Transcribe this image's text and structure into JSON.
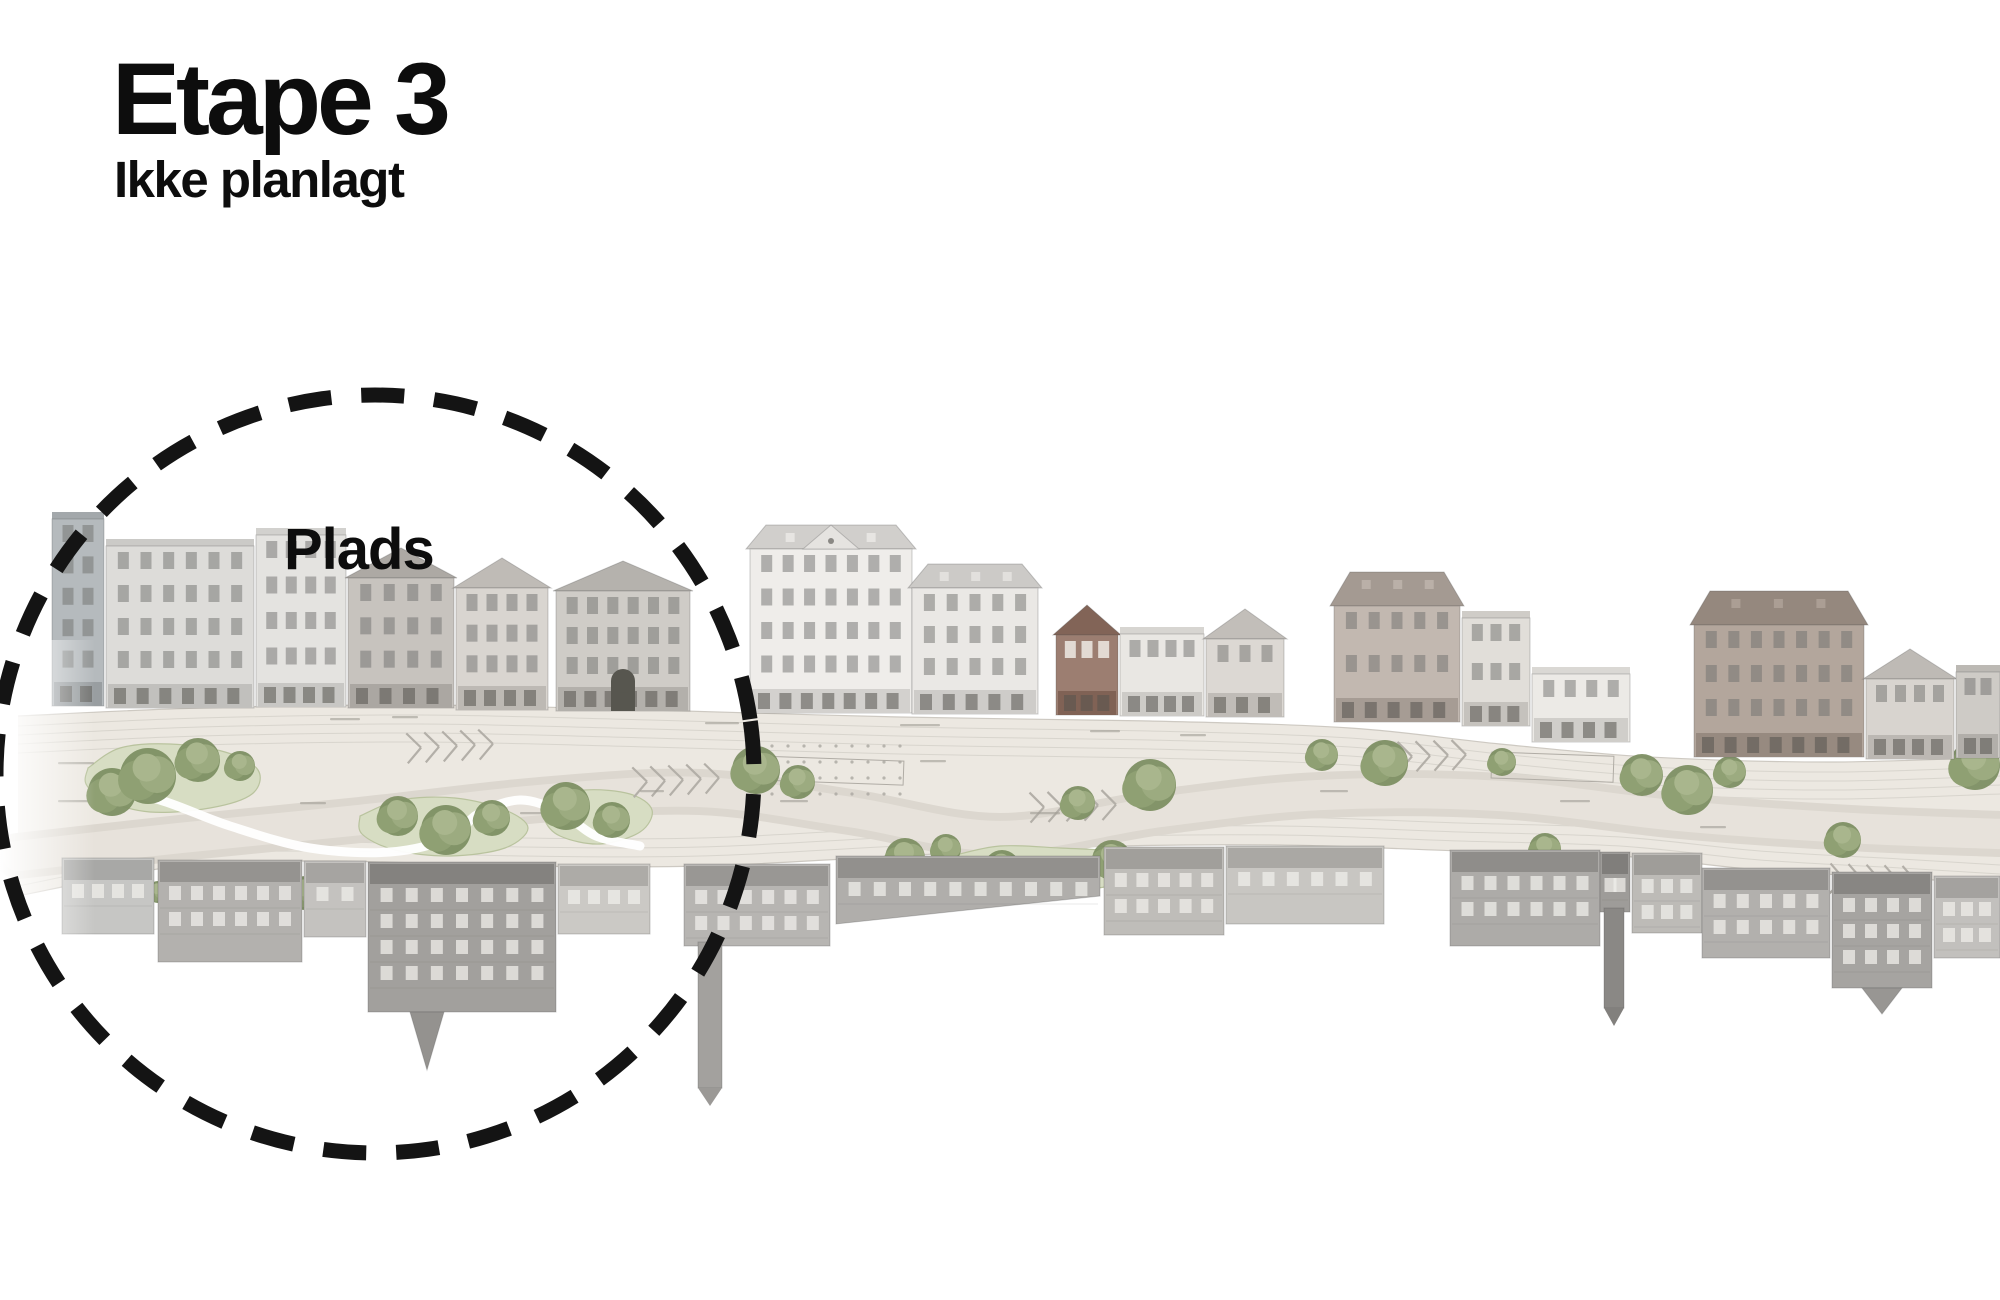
{
  "header": {
    "title": "Etape 3",
    "subtitle": "Ikke planlagt"
  },
  "annotation": {
    "label": "Plads",
    "circle": {
      "cx": 375,
      "cy": 774,
      "r": 379,
      "color": "#141414",
      "stroke_width": 15,
      "dash": "43 30"
    }
  },
  "palette": {
    "strip": "#ece8e1",
    "strip_edge": "#c9c4bd",
    "road": "#dcd7cf",
    "road_inner": "#e8e3dc",
    "lane": "#c9c5be",
    "lawn": "#d7ddc3",
    "lawn_edge": "#b9c39e",
    "tree_base": "#7d8f63",
    "tree_mid": "#8fa073",
    "tree_light": "#9cab80",
    "tree_top": "#a9b68d",
    "hatch": "#b3afa8",
    "dots": "#aaa6a0",
    "zone": "#b0aca5",
    "label_mark": "#a09c95",
    "path_white": "#ffffff",
    "win_dark": "#70706e",
    "win_light": "#efeeea",
    "store_pane": "#55544f",
    "outline": "rgba(80,80,78,0.28)"
  },
  "panorama": {
    "strip_top": [
      [
        18,
        716
      ],
      [
        200,
        708
      ],
      [
        420,
        705
      ],
      [
        650,
        710
      ],
      [
        900,
        717
      ],
      [
        1150,
        721
      ],
      [
        1350,
        728
      ],
      [
        1500,
        744
      ],
      [
        1650,
        757
      ],
      [
        1830,
        762
      ],
      [
        2000,
        757
      ]
    ],
    "strip_bottom": [
      [
        18,
        896
      ],
      [
        180,
        866
      ],
      [
        330,
        861
      ],
      [
        520,
        866
      ],
      [
        700,
        866
      ],
      [
        880,
        857
      ],
      [
        1080,
        847
      ],
      [
        1280,
        845
      ],
      [
        1460,
        851
      ],
      [
        1620,
        856
      ],
      [
        1760,
        870
      ],
      [
        1900,
        878
      ],
      [
        2000,
        884
      ]
    ],
    "road": {
      "points": [
        [
          18,
          856
        ],
        [
          180,
          838
        ],
        [
          360,
          820
        ],
        [
          540,
          800
        ],
        [
          700,
          792
        ],
        [
          850,
          812
        ],
        [
          1000,
          836
        ],
        [
          1160,
          812
        ],
        [
          1320,
          795
        ],
        [
          1500,
          796
        ],
        [
          1680,
          816
        ],
        [
          1850,
          828
        ],
        [
          2000,
          834
        ]
      ],
      "width": 46
    },
    "white_path": [
      [
        95,
        786
      ],
      [
        160,
        800
      ],
      [
        230,
        826
      ],
      [
        310,
        848
      ],
      [
        390,
        852
      ],
      [
        450,
        838
      ],
      [
        478,
        814
      ],
      [
        520,
        800
      ],
      [
        560,
        812
      ],
      [
        596,
        836
      ],
      [
        640,
        846
      ]
    ],
    "lawns": [
      [
        [
          88,
          768
        ],
        [
          120,
          748
        ],
        [
          170,
          744
        ],
        [
          225,
          752
        ],
        [
          258,
          770
        ],
        [
          252,
          794
        ],
        [
          210,
          808
        ],
        [
          150,
          812
        ],
        [
          105,
          800
        ],
        [
          86,
          784
        ]
      ],
      [
        [
          360,
          816
        ],
        [
          400,
          800
        ],
        [
          455,
          798
        ],
        [
          505,
          810
        ],
        [
          528,
          828
        ],
        [
          505,
          848
        ],
        [
          450,
          856
        ],
        [
          395,
          850
        ],
        [
          362,
          834
        ]
      ],
      [
        [
          548,
          800
        ],
        [
          585,
          790
        ],
        [
          630,
          794
        ],
        [
          652,
          810
        ],
        [
          640,
          832
        ],
        [
          600,
          844
        ],
        [
          560,
          836
        ],
        [
          544,
          818
        ]
      ],
      [
        [
          952,
          856
        ],
        [
          1000,
          846
        ],
        [
          1060,
          848
        ],
        [
          1120,
          852
        ],
        [
          1150,
          864
        ],
        [
          1118,
          884
        ],
        [
          1050,
          892
        ],
        [
          985,
          886
        ],
        [
          950,
          872
        ]
      ]
    ],
    "trees": [
      [
        112,
        792,
        24
      ],
      [
        148,
        776,
        28
      ],
      [
        198,
        760,
        22
      ],
      [
        240,
        766,
        15
      ],
      [
        124,
        898,
        13
      ],
      [
        158,
        892,
        11
      ],
      [
        305,
        893,
        17
      ],
      [
        398,
        816,
        20
      ],
      [
        446,
        830,
        25
      ],
      [
        492,
        818,
        18
      ],
      [
        566,
        806,
        24
      ],
      [
        612,
        820,
        18
      ],
      [
        756,
        770,
        24
      ],
      [
        798,
        782,
        17
      ],
      [
        905,
        858,
        20
      ],
      [
        946,
        849,
        15
      ],
      [
        1002,
        868,
        18
      ],
      [
        1058,
        876,
        16
      ],
      [
        1112,
        860,
        20
      ],
      [
        1078,
        803,
        17
      ],
      [
        1150,
        785,
        26
      ],
      [
        1322,
        755,
        16
      ],
      [
        1385,
        763,
        23
      ],
      [
        1502,
        762,
        14
      ],
      [
        1545,
        849,
        16
      ],
      [
        1642,
        775,
        21
      ],
      [
        1688,
        790,
        25
      ],
      [
        1730,
        772,
        16
      ],
      [
        1843,
        840,
        18
      ],
      [
        1975,
        765,
        25
      ]
    ],
    "hatches": [
      [
        288,
        897,
        -4
      ],
      [
        452,
        746,
        -3
      ],
      [
        678,
        780,
        -3
      ],
      [
        1075,
        806,
        -2
      ],
      [
        1425,
        756,
        -2
      ],
      [
        1875,
        880,
        2
      ]
    ],
    "dot_grids": [
      [
        756,
        746,
        150,
        62
      ],
      [
        1698,
        720,
        238,
        48
      ]
    ],
    "zone_rects": [
      [
        758,
        756,
        146,
        24
      ],
      [
        1492,
        752,
        122,
        26
      ]
    ],
    "micro_labels": [
      [
        330,
        718,
        30
      ],
      [
        392,
        716,
        26
      ],
      [
        705,
        722,
        34
      ],
      [
        900,
        724,
        40
      ],
      [
        1090,
        730,
        30
      ],
      [
        1180,
        734,
        26
      ],
      [
        58,
        762,
        36
      ],
      [
        58,
        800,
        36
      ],
      [
        300,
        802,
        26
      ],
      [
        520,
        812,
        30
      ],
      [
        640,
        790,
        24
      ],
      [
        780,
        800,
        28
      ],
      [
        1030,
        812,
        30
      ],
      [
        1320,
        790,
        28
      ],
      [
        1560,
        800,
        30
      ],
      [
        1700,
        826,
        26
      ],
      [
        470,
        864,
        30
      ],
      [
        720,
        866,
        34
      ],
      [
        1140,
        900,
        30
      ],
      [
        920,
        760,
        26
      ]
    ],
    "top_buildings": [
      {
        "x": 52,
        "w": 52,
        "h": 195,
        "base": 706,
        "c": "#b5babd",
        "roof": "flat"
      },
      {
        "x": 106,
        "w": 148,
        "h": 170,
        "base": 708,
        "c": "#dddcd9",
        "roof": "flat"
      },
      {
        "x": 256,
        "w": 90,
        "h": 180,
        "base": 707,
        "c": "#e4e3e0",
        "roof": "flat"
      },
      {
        "x": 348,
        "w": 106,
        "h": 160,
        "base": 708,
        "c": "#c7c3be",
        "roof": "gable"
      },
      {
        "x": 456,
        "w": 92,
        "h": 152,
        "base": 710,
        "c": "#d9d5d0",
        "roof": "gable"
      },
      {
        "x": 556,
        "w": 134,
        "h": 150,
        "base": 711,
        "c": "#cfccc7",
        "roof": "gable",
        "arch": 1
      },
      {
        "x": 750,
        "w": 162,
        "h": 188,
        "base": 713,
        "c": "#efedea",
        "roof": "hip",
        "pediment": 1
      },
      {
        "x": 912,
        "w": 126,
        "h": 150,
        "base": 714,
        "c": "#eae8e5",
        "roof": "hip"
      },
      {
        "x": 1056,
        "w": 62,
        "h": 110,
        "base": 715,
        "c": "#9c7e71",
        "roof": "gable",
        "red": 1
      },
      {
        "x": 1120,
        "w": 84,
        "h": 90,
        "base": 716,
        "c": "#e9e7e3",
        "roof": "flat"
      },
      {
        "x": 1206,
        "w": 78,
        "h": 108,
        "base": 717,
        "c": "#dcd8d3",
        "roof": "gable"
      },
      {
        "x": 1334,
        "w": 126,
        "h": 150,
        "base": 722,
        "c": "#c2b8b0",
        "roof": "mansard"
      },
      {
        "x": 1462,
        "w": 68,
        "h": 116,
        "base": 726,
        "c": "#e1ded9",
        "roof": "flat"
      },
      {
        "x": 1532,
        "w": 98,
        "h": 76,
        "base": 742,
        "c": "#eceae6",
        "roof": "flat"
      },
      {
        "x": 1694,
        "w": 170,
        "h": 166,
        "base": 757,
        "c": "#b3a69c",
        "roof": "mansard"
      },
      {
        "x": 1866,
        "w": 88,
        "h": 110,
        "base": 759,
        "c": "#d8d4cf",
        "roof": "gable"
      },
      {
        "x": 1956,
        "w": 44,
        "h": 94,
        "base": 758,
        "c": "#cecbc6",
        "roof": "flat"
      }
    ],
    "bottom_buildings": [
      {
        "x": 62,
        "w": 92,
        "top": 858,
        "d": 76,
        "c": "#c6c6c4"
      },
      {
        "x": 158,
        "w": 144,
        "top": 860,
        "d": 102,
        "c": "#b3b1ae"
      },
      {
        "x": 304,
        "w": 62,
        "top": 861,
        "d": 76,
        "c": "#c4c2bf"
      },
      {
        "x": 368,
        "w": 188,
        "top": 862,
        "d": 150,
        "c": "#a2a09d",
        "gable": {
          "dx": 42,
          "w": 34,
          "gd": 58
        }
      },
      {
        "x": 558,
        "w": 92,
        "top": 864,
        "d": 70,
        "c": "#cbc9c5"
      },
      {
        "x": 684,
        "w": 146,
        "top": 864,
        "d": 82,
        "c": "#b7b5b2",
        "tower": {
          "dx": 14,
          "w": 24,
          "td": 146
        }
      },
      {
        "x": 836,
        "w": 264,
        "top": 856,
        "d": 68,
        "c": "#b0aeab",
        "slant": -28
      },
      {
        "x": 1104,
        "w": 120,
        "top": 847,
        "d": 88,
        "c": "#bfbdb9"
      },
      {
        "x": 1226,
        "w": 158,
        "top": 846,
        "d": 78,
        "c": "#c8c6c2"
      },
      {
        "x": 1450,
        "w": 150,
        "top": 850,
        "d": 96,
        "c": "#adaba8"
      },
      {
        "x": 1600,
        "w": 30,
        "top": 852,
        "d": 60,
        "c": "#9e9c99",
        "tower": {
          "dx": 4,
          "w": 20,
          "td": 100
        }
      },
      {
        "x": 1632,
        "w": 70,
        "top": 853,
        "d": 80,
        "c": "#bdbbb7"
      },
      {
        "x": 1702,
        "w": 128,
        "top": 868,
        "d": 90,
        "c": "#b2b0ad"
      },
      {
        "x": 1832,
        "w": 100,
        "top": 872,
        "d": 116,
        "c": "#a6a4a1",
        "gable": {
          "dx": 30,
          "w": 40,
          "gd": 26
        }
      },
      {
        "x": 1934,
        "w": 66,
        "top": 876,
        "d": 82,
        "c": "#c2c0bd"
      }
    ]
  }
}
